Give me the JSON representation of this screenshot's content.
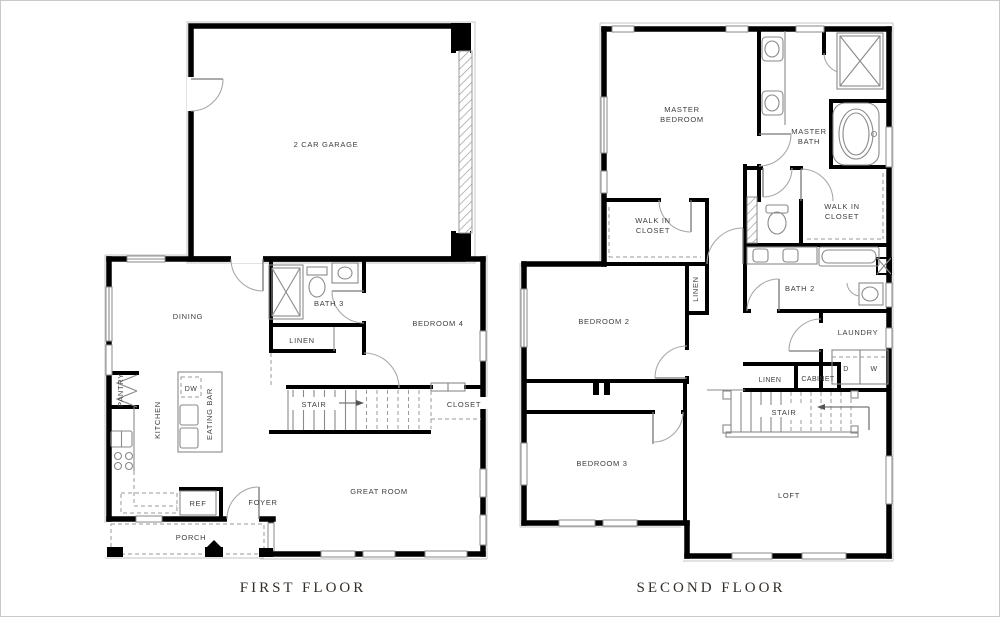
{
  "page": {
    "background": "#ffffff",
    "border_color": "#c9c9c9",
    "wall_color": "#000000",
    "fixture_line_color": "#8a8a8a",
    "dashed_line_color": "#9a9a9a",
    "label_color": "#3d3d3d",
    "title_color": "#332e29"
  },
  "first_floor": {
    "title": "FIRST FLOOR",
    "labels": {
      "garage": "2 CAR GARAGE",
      "dining": "DINING",
      "pantry": "PANTRY",
      "kitchen": "KITCHEN",
      "dw": "DW",
      "eating_bar": "EATING BAR",
      "bath3": "BATH 3",
      "linen": "LINEN",
      "bedroom4": "BEDROOM 4",
      "stair": "STAIR",
      "closet": "CLOSET",
      "great_room": "GREAT ROOM",
      "ref": "REF",
      "foyer": "FOYER",
      "porch": "PORCH"
    }
  },
  "second_floor": {
    "title": "SECOND FLOOR",
    "labels": {
      "master_bedroom_line1": "MASTER",
      "master_bedroom_line2": "BEDROOM",
      "master_bath_line1": "MASTER",
      "master_bath_line2": "BATH",
      "walkin_left_line1": "WALK IN",
      "walkin_left_line2": "CLOSET",
      "walkin_right_line1": "WALK IN",
      "walkin_right_line2": "CLOSET",
      "bedroom2": "BEDROOM 2",
      "linen_hall": "LINEN",
      "bath2": "BATH 2",
      "laundry": "LAUNDRY",
      "dryer": "D",
      "washer": "W",
      "linen2": "LINEN",
      "cabinet": "CABINET",
      "stair": "STAIR",
      "bedroom3": "BEDROOM 3",
      "loft": "LOFT"
    }
  }
}
